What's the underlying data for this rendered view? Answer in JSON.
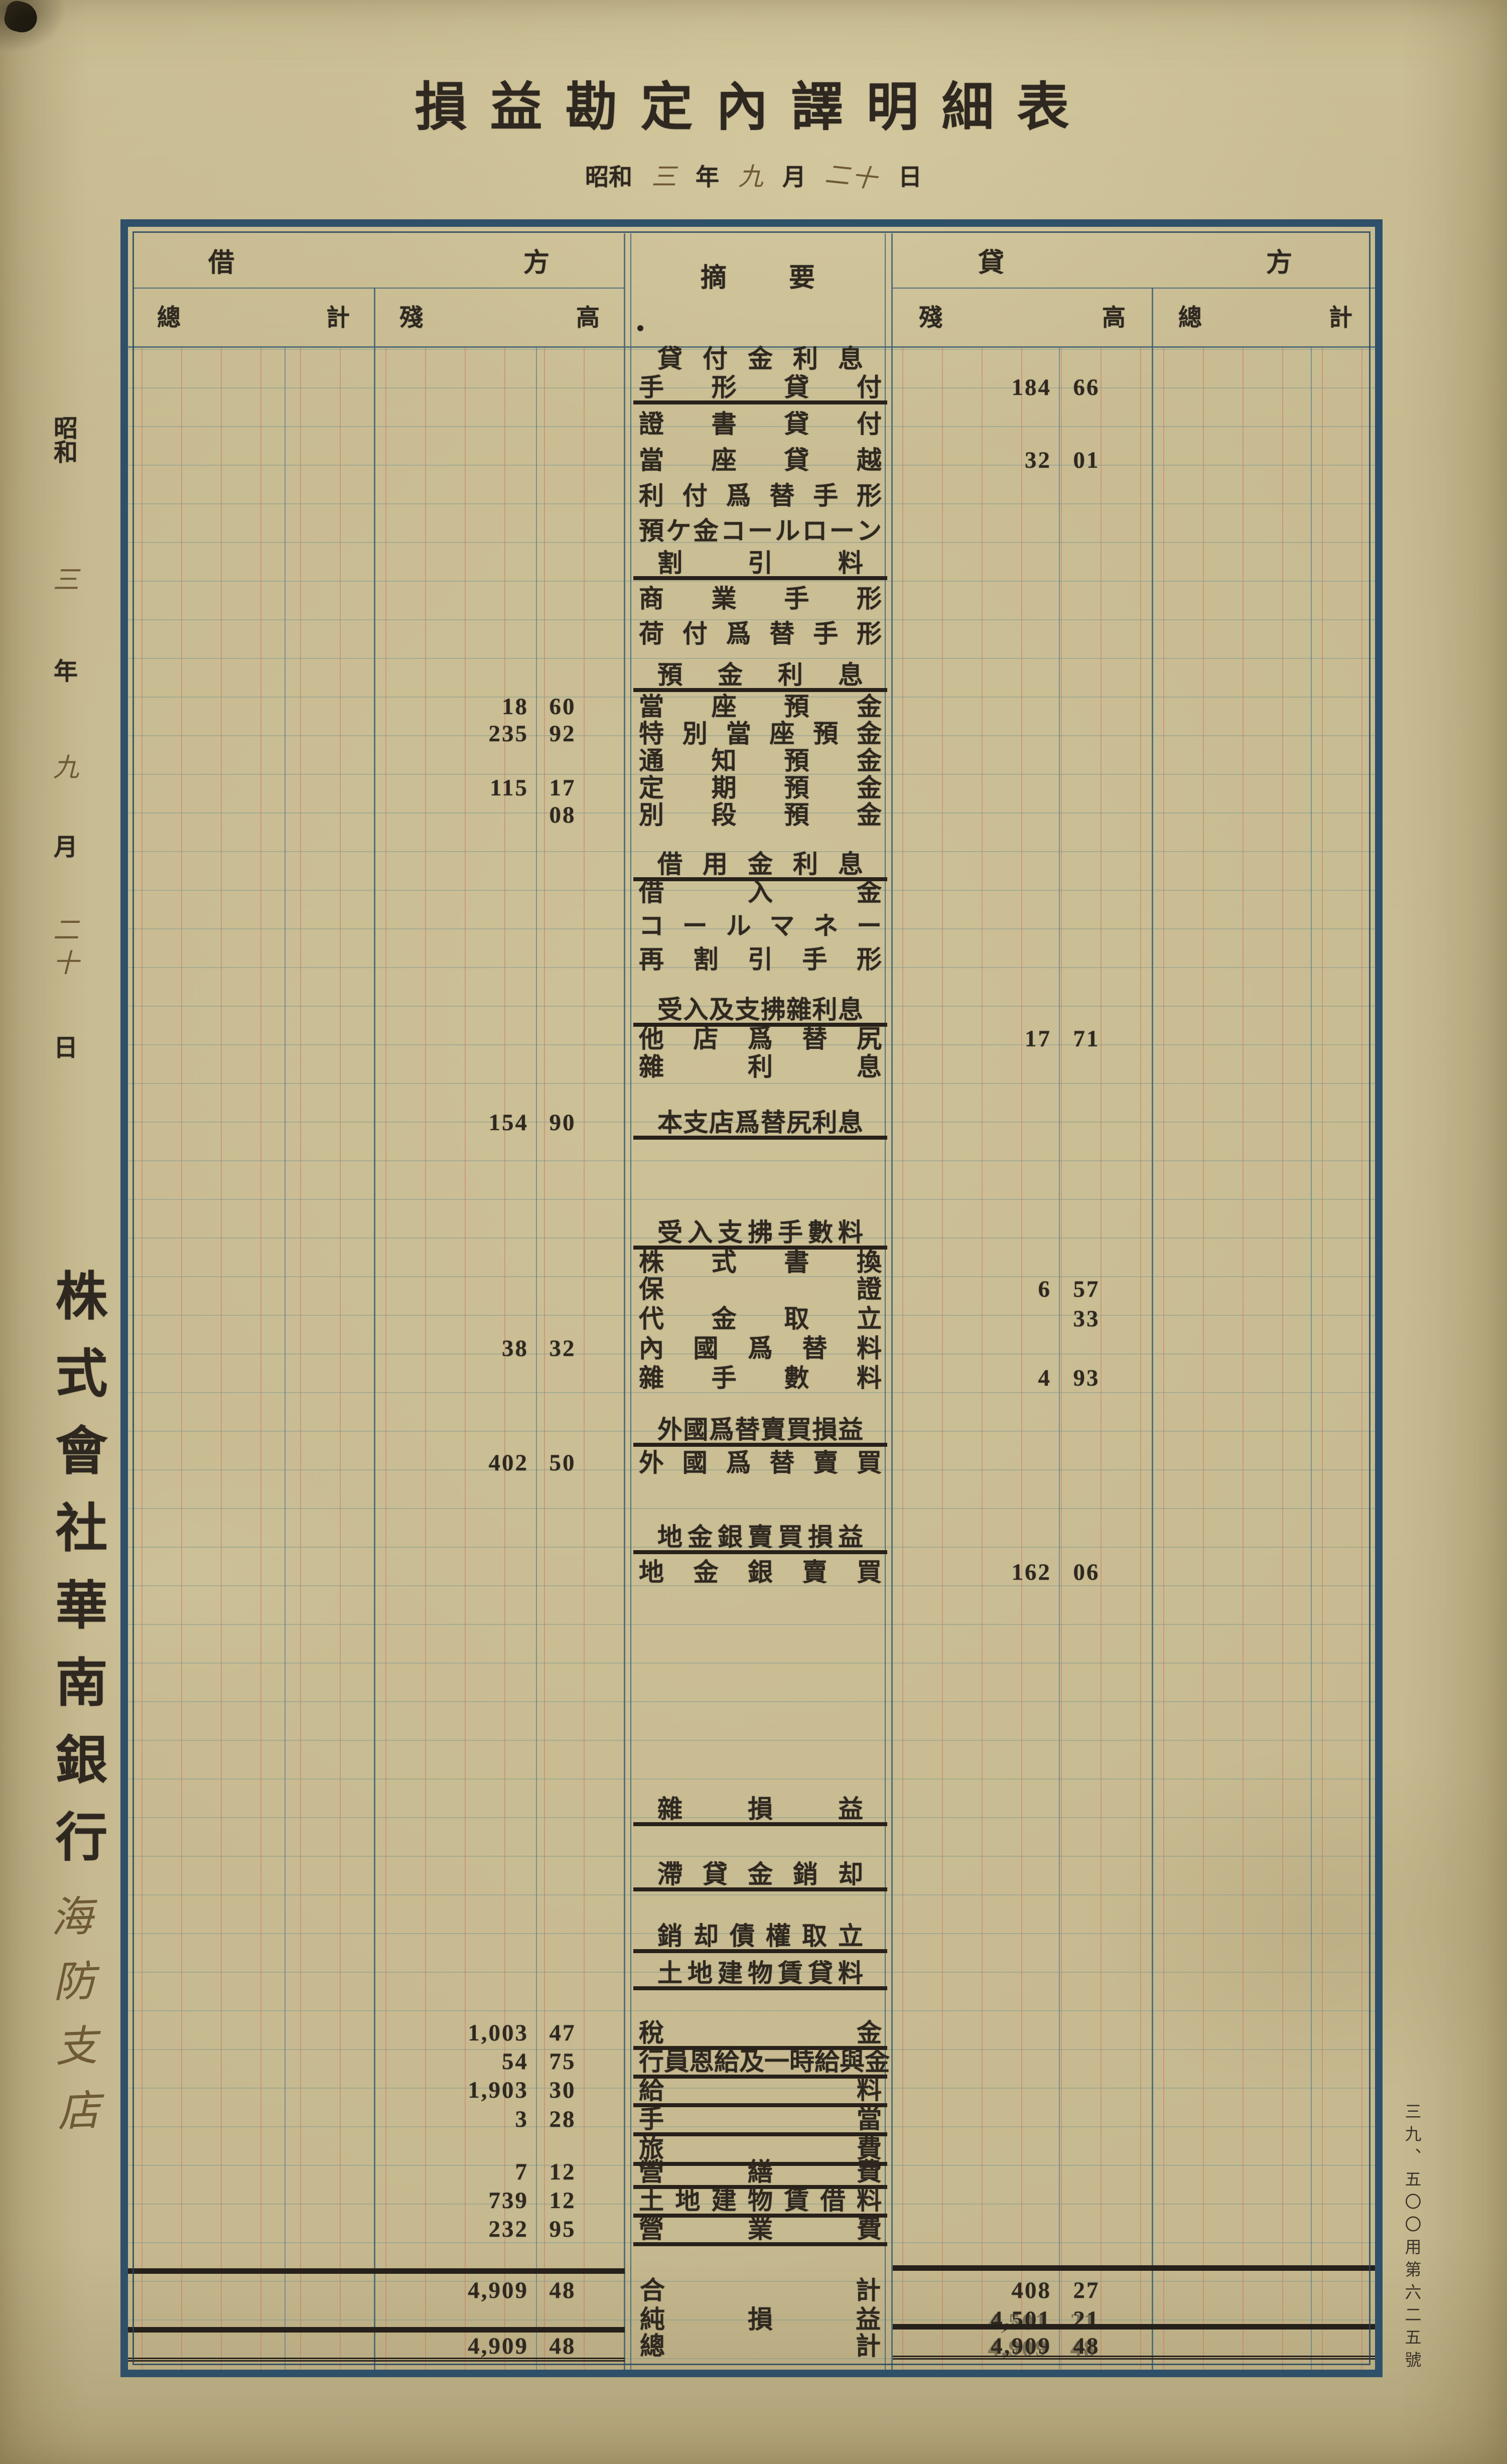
{
  "title": "損益勘定內譯明細表",
  "date": {
    "era": "昭和",
    "year": "三",
    "year_label": "年",
    "month": "九",
    "month_label": "月",
    "day": "二十",
    "day_label": "日"
  },
  "company": "株式會社華南銀行",
  "branch": "海防支店",
  "form_number": "三九、五〇〇用第六二五號",
  "table": {
    "header": {
      "debit": "借方",
      "summary": "摘要",
      "credit": "貸方",
      "debit_total": "總計",
      "debit_balance": "殘高",
      "credit_balance": "殘高",
      "credit_total": "總計"
    },
    "rows": [
      {
        "label": "貸付金利息"
      },
      {
        "label": "手形貸付",
        "credit_yen": "184",
        "credit_sen": "66"
      },
      {
        "label": "證書貸付"
      },
      {
        "label": "當座貸越",
        "credit_yen": "32",
        "credit_sen": "01"
      },
      {
        "label": "利付爲替手形"
      },
      {
        "label": "預ケ金コールローン"
      },
      {
        "label": "割引料"
      },
      {
        "label": "商業手形"
      },
      {
        "label": "荷付爲替手形"
      },
      {
        "label": "預金利息"
      },
      {
        "label": "當座預金",
        "debit_yen": "18",
        "debit_sen": "60"
      },
      {
        "label": "特別當座預金",
        "debit_yen": "235",
        "debit_sen": "92"
      },
      {
        "label": "通知預金"
      },
      {
        "label": "定期預金",
        "debit_yen": "115",
        "debit_sen": "17"
      },
      {
        "label": "別段預金",
        "debit_sen": "08"
      },
      {
        "label": "借用金利息"
      },
      {
        "label": "借入金"
      },
      {
        "label": "コールマネー"
      },
      {
        "label": "再割引手形"
      },
      {
        "label": "受入及支拂雜利息"
      },
      {
        "label": "他店爲替尻",
        "credit_yen": "17",
        "credit_sen": "71"
      },
      {
        "label": "雜利息"
      },
      {
        "label": "本支店爲替尻利息",
        "debit_yen": "154",
        "debit_sen": "90"
      },
      {
        "label": "受入支拂手數料"
      },
      {
        "label": "株式書換"
      },
      {
        "label": "保證",
        "credit_yen": "6",
        "credit_sen": "57"
      },
      {
        "label": "代金取立",
        "credit_sen": "33"
      },
      {
        "label": "內國爲替料",
        "debit_yen": "38",
        "debit_sen": "32"
      },
      {
        "label": "雜手數料",
        "credit_yen": "4",
        "credit_sen": "93"
      },
      {
        "label": "外國爲替賣買損益"
      },
      {
        "label": "外國爲替賣買",
        "debit_yen": "402",
        "debit_sen": "50"
      },
      {
        "label": "地金銀賣買損益"
      },
      {
        "label": "地金銀賣買",
        "credit_yen": "162",
        "credit_sen": "06"
      },
      {
        "label": "雜損益"
      },
      {
        "label": "滯貸金銷却"
      },
      {
        "label": "銷却債權取立"
      },
      {
        "label": "土地建物賃貸料"
      },
      {
        "label": "稅金",
        "debit_yen": "1,003",
        "debit_sen": "47"
      },
      {
        "label": "行員恩給及一時給與金",
        "debit_yen": "54",
        "debit_sen": "75"
      },
      {
        "label": "給料",
        "debit_yen": "1,903",
        "debit_sen": "30"
      },
      {
        "label": "手當",
        "debit_yen": "3",
        "debit_sen": "28"
      },
      {
        "label": "旅費"
      },
      {
        "label": "營繕費",
        "debit_yen": "7",
        "debit_sen": "12"
      },
      {
        "label": "土地建物賃借料",
        "debit_yen": "739",
        "debit_sen": "12"
      },
      {
        "label": "營業費",
        "debit_yen": "232",
        "debit_sen": "95"
      },
      {
        "label": "合計",
        "debit_yen": "4,909",
        "debit_sen": "48",
        "credit_yen": "408",
        "credit_sen": "27"
      },
      {
        "label": "純損益",
        "credit_yen": "4,501",
        "credit_sen": "21"
      },
      {
        "label": "總計",
        "debit_yen": "4,909",
        "debit_sen": "48",
        "credit_yen": "4,909",
        "credit_sen": "48"
      }
    ]
  }
}
